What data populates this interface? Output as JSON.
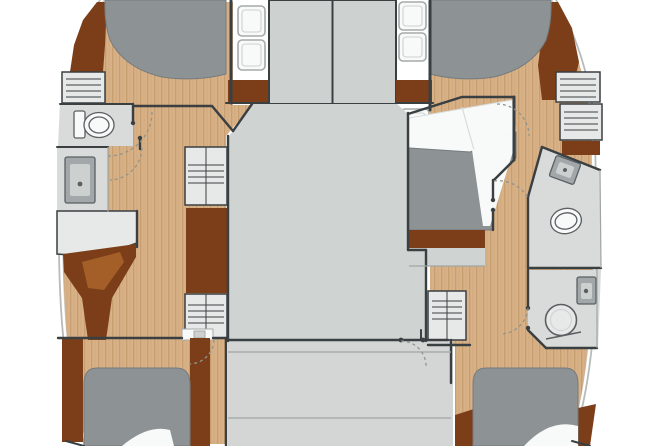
{
  "title": "catamaran-yacht-floor-plan",
  "canvas": {
    "width": 655,
    "height": 446
  },
  "colors": {
    "bg": "#ffffff",
    "hull_line": "#b7bbb9",
    "wall": "#3a3f42",
    "wall_soft": "#6f7477",
    "line_soft": "#a0a5a3",
    "wood": "#d8b186",
    "wood_stripe": "#c69e70",
    "wood_dark": "#7c3e18",
    "wood_mid": "#a45f28",
    "deck": "#cfd3d1",
    "panel": "#cdd2d0",
    "cockpit": "#d3d6d4",
    "room": "#d8dbd9",
    "hatch_unit": "#e7e9e8",
    "bed": "#8d9295",
    "bed_edge": "#767b7e",
    "white": "#f8fafa",
    "pillow_line": "#d9dcdb",
    "fixture": "#a2a7a9",
    "fixture_light": "#ccd0cf",
    "fixture_dark": "#5a5f62",
    "hatch_stroke": "#a5aaa9",
    "arc": "#90958f"
  },
  "legend": {
    "rooms": [
      {
        "id": "port-forward-cabin",
        "label": "Port forward cabin with double berth"
      },
      {
        "id": "port-head",
        "label": "Port head (toilet room)"
      },
      {
        "id": "port-shower-room",
        "label": "Port shower / vanity room"
      },
      {
        "id": "port-desk-area",
        "label": "Port desk and seat"
      },
      {
        "id": "port-aft-cabin",
        "label": "Port aft cabin with double berth"
      },
      {
        "id": "foredeck-walkway",
        "label": "Foredeck walkway with deck hatches"
      },
      {
        "id": "salon",
        "label": "Central salon"
      },
      {
        "id": "cockpit",
        "label": "Aft cockpit"
      },
      {
        "id": "starboard-forward-cabin",
        "label": "Starboard forward cabin with double berth"
      },
      {
        "id": "starboard-midship-cabin",
        "label": "Starboard midship cabin with berth"
      },
      {
        "id": "starboard-head",
        "label": "Starboard head (toilet + sink)"
      },
      {
        "id": "starboard-shower-room",
        "label": "Starboard shower room with sink"
      },
      {
        "id": "starboard-aft-cabin",
        "label": "Starboard aft cabin with double berth"
      }
    ],
    "fixtures": [
      {
        "id": "berths",
        "count": 5
      },
      {
        "id": "toilets",
        "count": 2
      },
      {
        "id": "sinks",
        "count": 3
      },
      {
        "id": "showers",
        "count": 1
      },
      {
        "id": "storage-units",
        "count": 6
      },
      {
        "id": "deck-hatches",
        "count": 5
      }
    ]
  }
}
